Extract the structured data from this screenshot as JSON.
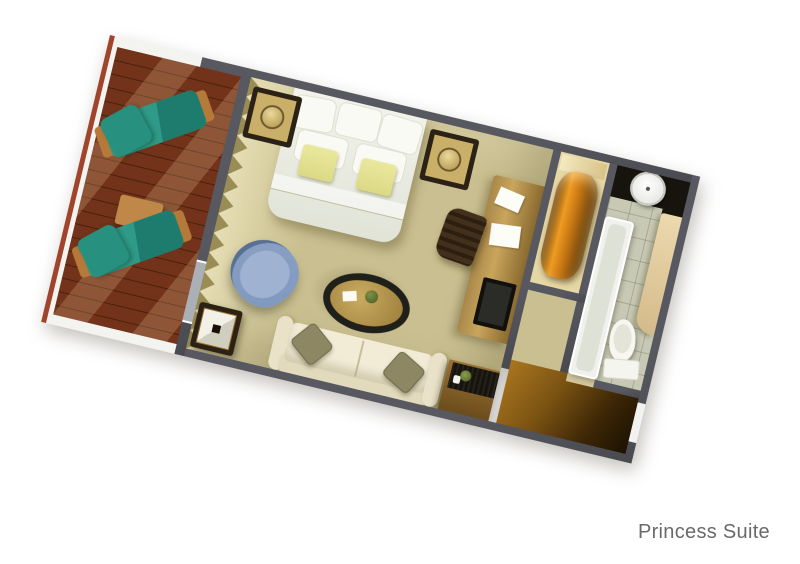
{
  "caption": {
    "text": "Princess Suite"
  },
  "colors": {
    "bg": "#ffffff",
    "label": "#6a6a6a",
    "wall": "#585860",
    "railing": "#f3f3f0",
    "trim": "#a0452b",
    "deckline": "#49200b",
    "lounger": "#2f9a87",
    "loungerframe": "#b5793a",
    "woodlight": "#c08848",
    "carpet": "#c9bf90",
    "curtain": "#9a8c55",
    "duvet": "#f2f3ec",
    "pillowwhite": "#fafaf5",
    "pillowyellow": "#dcd985",
    "nightstand": "#2c2115",
    "lamp": "#c9af67",
    "deskwood": "#c9a55c",
    "chairdark": "#2c1f10",
    "chairblue": "#7f98bf",
    "tablerim": "#20201a",
    "tabletop": "#9b7c3a",
    "sofa": "#f2ecd7",
    "sofapillow": "#8d8764",
    "amber": "#c87714",
    "tile": "#c8c9b4",
    "counter": "#17130d",
    "fixture": "#f0f1ec",
    "beige": "#d4ba8a",
    "glass": "#aab0b6",
    "entrywood": "#a9761f",
    "entrydark": "#1c1202"
  }
}
